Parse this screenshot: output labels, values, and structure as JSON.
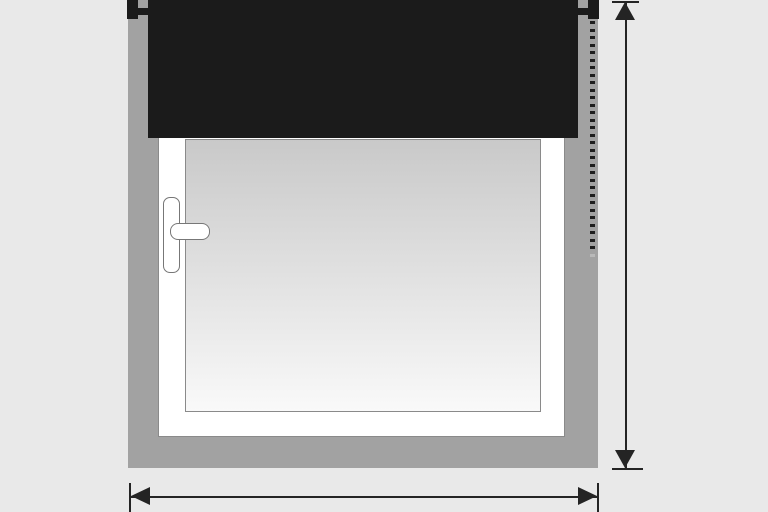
{
  "colors": {
    "background": "#e9e9e9",
    "wall": "#a2a2a2",
    "blind": "#1b1b1b",
    "bracket": "#1b1b1b",
    "frame": "#ffffff",
    "outline": "#8a8a8a",
    "glass_top": "#c9c9c9",
    "glass_bottom": "#f9f9f9",
    "handle": "#ffffff",
    "handle_outline": "#777777",
    "chain": "#1e1e1e",
    "chain_end": "#b9b9b9",
    "arrow": "#242424"
  },
  "chain": {
    "bead_count": 31
  }
}
